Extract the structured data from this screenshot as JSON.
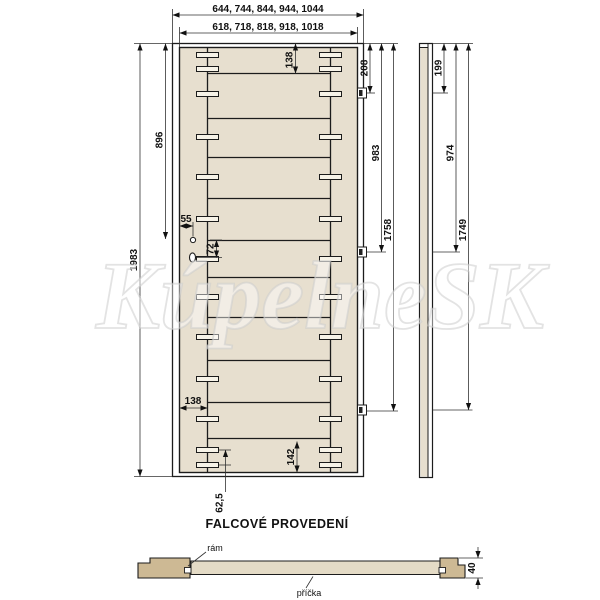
{
  "watermark": "KúpelneSK",
  "section_title": "FALCOVÉ PROVEDENÍ",
  "front_view": {
    "width_options_frame": "644, 744, 844, 944, 1044",
    "width_options_leaf": "618, 718, 818, 918, 1018",
    "height": "1983",
    "top_rail_height": "138",
    "handle_height": "896",
    "handle_edge_offset": "55",
    "lock_distance": "72",
    "stile_width": "138",
    "bottom_rail_height": "142",
    "dowel_offset": "62,5",
    "hinge_top": "208",
    "hinge_middle": "983",
    "hinge_bottom": "1758"
  },
  "side_view": {
    "hinge_top": "199",
    "hinge_middle": "974",
    "hinge_bottom": "1749"
  },
  "cross_section": {
    "frame_label": "rám",
    "slat_label": "příčka",
    "thickness": "40"
  },
  "colors": {
    "leaf_fill": "#e7dfcf",
    "frame_block_fill": "#cdb994",
    "panel_fill": "#e4dbc6",
    "line": "#1c1c1c"
  }
}
